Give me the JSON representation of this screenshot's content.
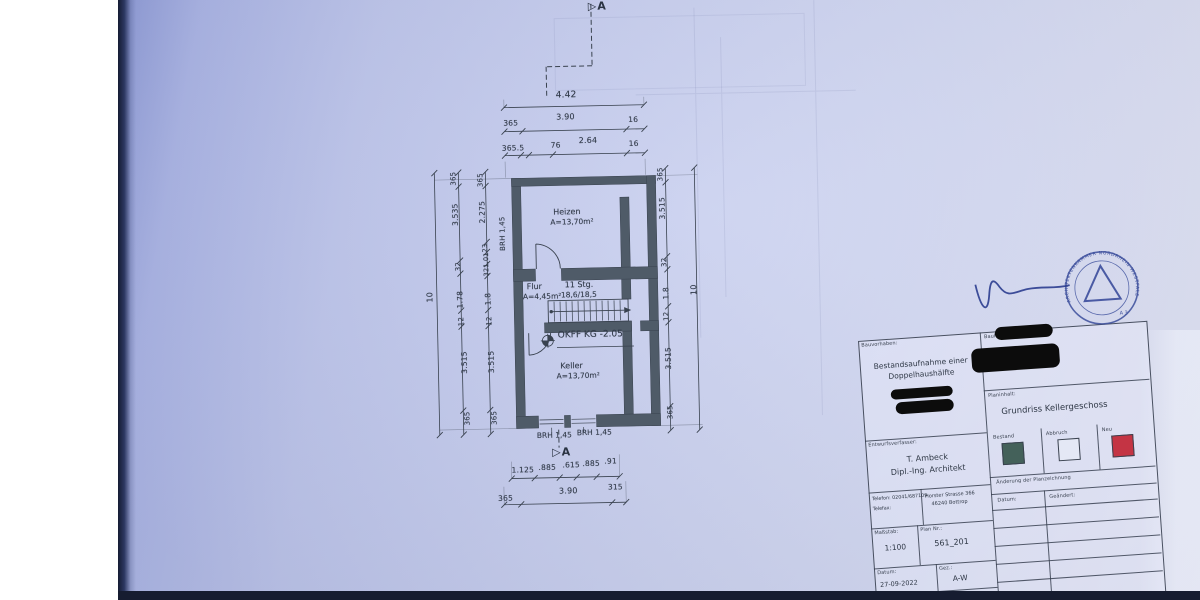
{
  "markers": {
    "top": "▷A",
    "bottom": "▷A"
  },
  "plan": {
    "rooms": [
      {
        "name": "Heizen",
        "area": "A=13,70m²"
      },
      {
        "name": "Flur",
        "area": "A=4,45m²"
      },
      {
        "name": "Keller",
        "area": "A=13,70m²"
      }
    ],
    "stairs": {
      "line1": "11 Stg.",
      "line2": "18,6/18,5"
    },
    "level": "OKFF KG -2.05",
    "brh_left": "BRH 1,45",
    "brh_bottom_left": "BRH 1,45",
    "brh_bottom_right": "BRH 1,45"
  },
  "dims": {
    "top_total": "4.42",
    "top_row2": [
      "365",
      "3.90",
      "16"
    ],
    "top_row3": [
      "365.5",
      "76",
      "2.64",
      "16"
    ],
    "left_total": "10",
    "left_mid": [
      "365",
      "3.535",
      "32",
      "1.78",
      "12",
      "3.515",
      "365"
    ],
    "left_inner": [
      "365",
      "2.275",
      "23",
      "1.01",
      "32",
      "1.8",
      "12",
      "3.515",
      "365"
    ],
    "right_inner": [
      "365",
      "3.515",
      "32",
      "1.8",
      "12",
      "3.515",
      "365"
    ],
    "right_total": "10",
    "bottom_row1": [
      "1.125",
      ".885",
      ".615",
      ".885",
      ".91"
    ],
    "bottom_row2": [
      "365",
      "3.90",
      "315"
    ]
  },
  "titleblock": {
    "bauvorhaben_label": "Bauvorhaben:",
    "bauvorhaben_line1": "Bestandsaufnahme einer",
    "bauvorhaben_line2": "Doppelhaushälfte",
    "bauherr_label": "Bauherr:",
    "planinhalt_label": "Planinhalt:",
    "planinhalt": "Grundriss Kellergeschoss",
    "entwurf_label": "Entwurfsverfasser:",
    "architect_name": "T. Ambeck",
    "architect_title": "Dipl.-Ing. Architekt",
    "telefon": "Telefon: 02041/687109",
    "telefax": "Telefax:",
    "address1": "Horster Strasse 366",
    "address2": "46240 Bottrop",
    "massstab_label": "Maßstab:",
    "massstab": "1:100",
    "plannr_label": "Plan Nr.:",
    "plannr": "561_201",
    "datum_label": "Datum:",
    "datum": "27-09-2022",
    "gez_label": "Gez.:",
    "gez": "A-W",
    "datum2_label": "Datum:",
    "gep_label": "Gep.:",
    "legend": [
      {
        "label": "Bestand",
        "color": "#44615a"
      },
      {
        "label": "Abbruch",
        "color": "#e4e8f5"
      },
      {
        "label": "Neu",
        "color": "#c43444"
      }
    ],
    "aenderung_label": "Änderung der Planzeichnung",
    "aend_datum_label": "Datum:",
    "aend_geaendert_label": "Geändert:"
  },
  "stamp": {
    "arc_text": "ARCHITEKTENKAMMER NORDRHEIN-WESTFALEN",
    "note": "A 3"
  },
  "colors": {
    "wall": "#4f5b68",
    "paper": "#c6cdee",
    "stamp_blue": "#3b4d9b",
    "redaction": "#0c0c0c"
  }
}
